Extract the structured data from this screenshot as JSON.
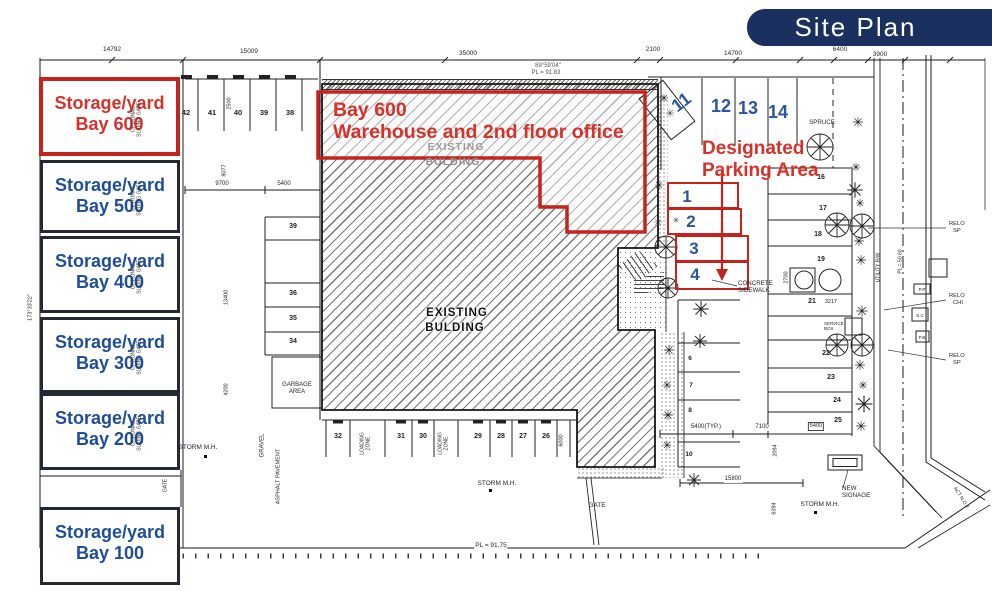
{
  "banner": {
    "title": "Site Plan"
  },
  "colors": {
    "highlight_red": "#c5231d",
    "annotation_red": "#d7322a",
    "annotation_blue": "#2a56a0",
    "bay_text_blue": "#1e4f96",
    "banner_bg": "#1a3160"
  },
  "bays": [
    {
      "line1": "Storage/yard",
      "line2": "Bay 600"
    },
    {
      "line1": "Storage/yard",
      "line2": "Bay 500"
    },
    {
      "line1": "Storage/yard",
      "line2": "Bay 400"
    },
    {
      "line1": "Storage/yard",
      "line2": "Bay 300"
    },
    {
      "line1": "Storage/yard",
      "line2": "Bay 200"
    },
    {
      "line1": "Storage/yard",
      "line2": "Bay 100"
    }
  ],
  "overlay": {
    "line1": "Bay 600",
    "line2": "Warehouse and 2nd floor office"
  },
  "designated": {
    "line1": "Designated",
    "line2": "Parking Area"
  },
  "stalls": {
    "top": [
      "42",
      "41",
      "40",
      "39",
      "38"
    ],
    "upper_right": [
      "11",
      "12",
      "13",
      "14"
    ],
    "numbered_red": [
      "1",
      "2",
      "3",
      "4"
    ],
    "mid": [
      "39",
      "36",
      "35",
      "34"
    ],
    "bottom": [
      "32",
      "31",
      "30",
      "29",
      "28",
      "27",
      "26"
    ],
    "right": [
      "16",
      "17",
      "18",
      "19",
      "21",
      "22",
      "23",
      "24",
      "25"
    ],
    "east": [
      "6",
      "7",
      "8",
      "10"
    ]
  },
  "plan_labels": {
    "existing": "EXISTING",
    "building": "BULDING",
    "garbage_line1": "GARBAGE",
    "garbage_line2": "AREA",
    "loading_line1": "LOADING",
    "loading_line2": "ZONE",
    "storm_mh": "STORM M.H.",
    "gate": "GATE",
    "concrete_line1": "CONCRETE",
    "concrete_line2": "SIDEWALK",
    "spruce": "SPRUCE",
    "new_signage_line1": "NEW",
    "new_signage_line2": "SIGNAGE",
    "relo": "RELO",
    "relo_sp": "SP",
    "relo_chi": "CHI",
    "gravel": "GRAVEL",
    "asphalt": "ASPHALT PAVEMENT",
    "optional": "OPTIONAL",
    "sliding_gate": "SLIDING GATE",
    "pp": "P.P",
    "sc": "S.C",
    "pb": "P.B",
    "service_line1": "SERVICE",
    "service_line2": "BOX",
    "utility": "UTILITY R/W",
    "act": "ACT N.O.T."
  },
  "dimensions": {
    "top": [
      "14792",
      "15009",
      "35000",
      "2100",
      "14700",
      "6400",
      "3900"
    ],
    "bearing": "89°59'04\"",
    "pl_top": "PL = 91.83",
    "pl_bottom": "PL = 91.75",
    "pl_left": "173°33'22\"",
    "pl_right": "PL = 50.60",
    "d9700": "9700",
    "d5400": "5400",
    "d8077": "8077",
    "d13400": "13400",
    "d4200": "4200",
    "d2500": "2500",
    "d7100": "7100",
    "d5400typ": "5400(TYP.)",
    "d15800": "15800",
    "d3217": "3217",
    "d2094": "2094",
    "d6394": "6394",
    "d6000": "6000",
    "d2700": "2700",
    "d5400b": "5400"
  }
}
